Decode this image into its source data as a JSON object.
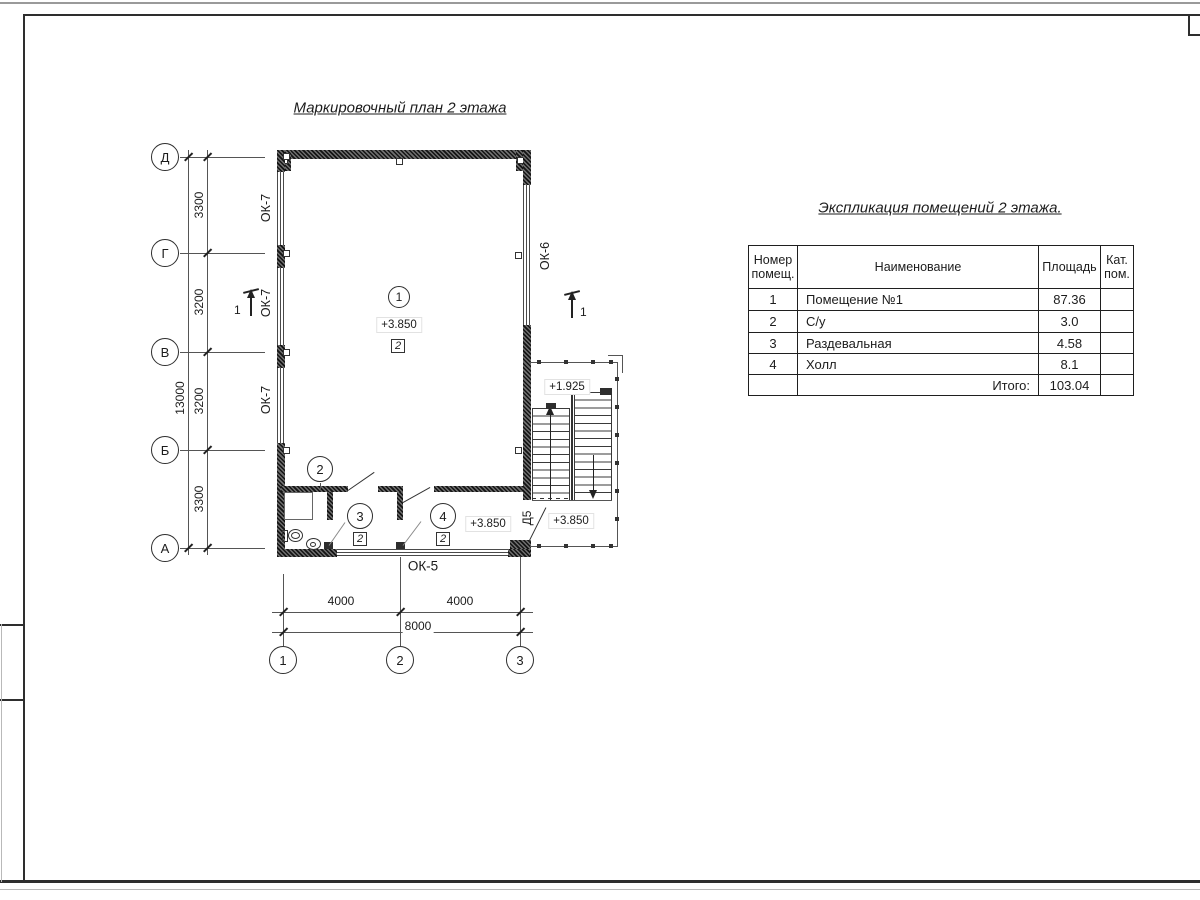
{
  "drawing": {
    "title": "Маркировочный план 2 этажа",
    "axes_rows": [
      "Д",
      "Г",
      "В",
      "Б",
      "А"
    ],
    "axes_cols": [
      "1",
      "2",
      "3"
    ],
    "dims": {
      "seg1": "3300",
      "seg2": "3200",
      "seg3": "3200",
      "seg4": "3300",
      "v_total": "13000",
      "h1": "4000",
      "h2": "4000",
      "h_total": "8000"
    },
    "marks": {
      "ok7": "ОК-7",
      "ok6": "ОК-6",
      "ok5": "ОК-5",
      "d5": "Д5"
    },
    "rooms": {
      "n1": "1",
      "n2": "2",
      "n3": "3",
      "n4": "4",
      "tag": "2"
    },
    "elevations": {
      "main": "+3.850",
      "hall": "+3.850",
      "annex": "+3.850",
      "landing": "+1.925"
    },
    "section": {
      "label": "1"
    }
  },
  "table": {
    "title": "Экспликация помещений 2 этажа.",
    "headers": {
      "num": "Номер помещ.",
      "name": "Наименование",
      "area": "Площадь",
      "cat": "Кат. пом."
    },
    "rows": [
      {
        "num": "1",
        "name": "Помещение №1",
        "area": "87.36",
        "cat": ""
      },
      {
        "num": "2",
        "name": "С/у",
        "area": "3.0",
        "cat": ""
      },
      {
        "num": "3",
        "name": "Раздевальная",
        "area": "4.58",
        "cat": ""
      },
      {
        "num": "4",
        "name": "Холл",
        "area": "8.1",
        "cat": ""
      }
    ],
    "total_label": "Итого:",
    "total_value": "103.04"
  }
}
